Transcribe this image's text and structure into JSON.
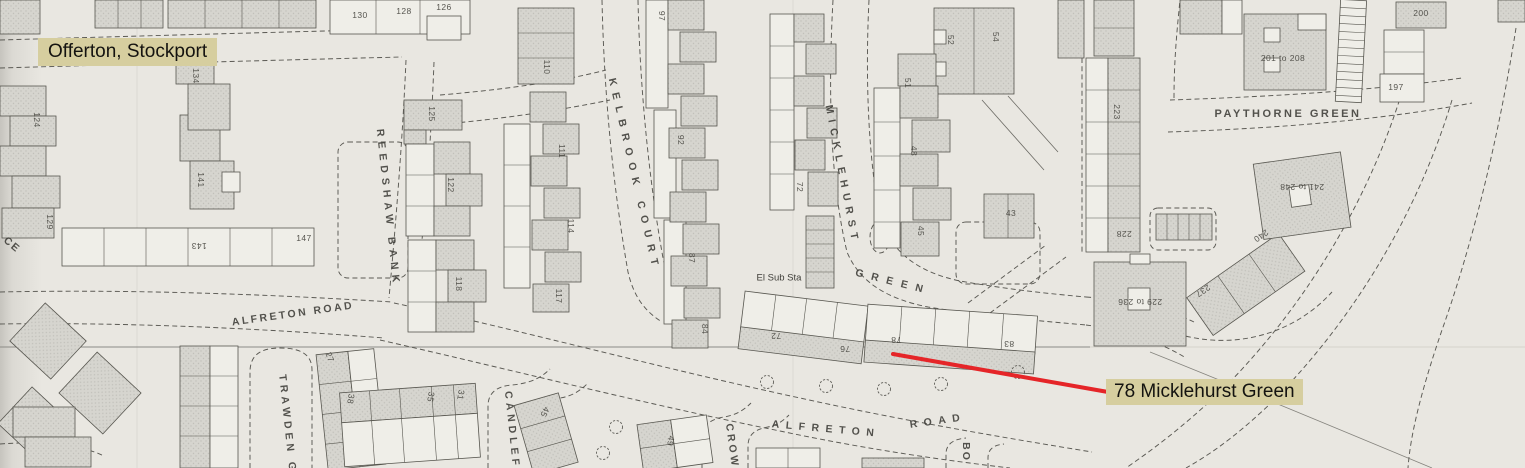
{
  "map": {
    "colors": {
      "highlight": "#d6ce9f",
      "pointer": "#e52528",
      "paper": "#e9e7e1",
      "building_fill": "#d6d5cf",
      "line_ink": "#57564f"
    },
    "annotation": {
      "region_note": "Offerton, Stockport",
      "target_note": "78 Micklehurst Green",
      "pointer_line": {
        "x1": 893,
        "y1": 354,
        "x2": 1108,
        "y2": 392
      }
    },
    "street_labels": [
      {
        "t": "REEDSHAW  BANK",
        "x": 388,
        "y": 208,
        "r": 84,
        "ls": 5,
        "s": 10.5
      },
      {
        "t": "KELBROOK  COURT",
        "x": 634,
        "y": 175,
        "r": 77,
        "ls": 7,
        "s": 10.5
      },
      {
        "t": "MICKLEHURST",
        "x": 842,
        "y": 175,
        "r": 79,
        "ls": 6,
        "s": 10.5
      },
      {
        "t": "GREEN",
        "x": 893,
        "y": 282,
        "r": 14,
        "ls": 8,
        "s": 10.5
      },
      {
        "t": "PAYTHORNE  GREEN",
        "x": 1288,
        "y": 114,
        "r": 0,
        "ls": 2.5,
        "s": 11
      },
      {
        "t": "ALFRETON  ROAD",
        "x": 293,
        "y": 314,
        "r": -8,
        "ls": 2.5,
        "s": 10.5
      },
      {
        "t": "ALFRETON",
        "x": 826,
        "y": 429,
        "r": 5,
        "ls": 6.5,
        "s": 10.5
      },
      {
        "t": "ROAD",
        "x": 938,
        "y": 421,
        "r": -8,
        "ls": 6.5,
        "s": 10.5
      },
      {
        "t": "TRAWDEN  GR",
        "x": 288,
        "y": 430,
        "r": 84,
        "ls": 4,
        "s": 10.5
      },
      {
        "t": "CANDLEF",
        "x": 512,
        "y": 430,
        "r": 84,
        "ls": 4,
        "s": 10.5
      },
      {
        "t": "CROW",
        "x": 732,
        "y": 446,
        "r": 82,
        "ls": 3,
        "s": 10.5
      },
      {
        "t": "BO",
        "x": 966,
        "y": 452,
        "r": 90,
        "ls": 2,
        "s": 10.5
      },
      {
        "t": "CE",
        "x": 12,
        "y": 245,
        "r": 40,
        "ls": 2,
        "s": 10.5
      }
    ],
    "feature_labels": [
      {
        "t": "El Sub Sta",
        "x": 779,
        "y": 278,
        "r": 0,
        "ls": 0,
        "s": 9.5
      }
    ],
    "house_numbers": [
      {
        "t": "124",
        "x": 37,
        "y": 120,
        "r": 90
      },
      {
        "t": "129",
        "x": 50,
        "y": 222,
        "r": 90
      },
      {
        "t": "134",
        "x": 196,
        "y": 76,
        "r": 90
      },
      {
        "t": "141",
        "x": 201,
        "y": 180,
        "r": 90
      },
      {
        "t": "143",
        "x": 199,
        "y": 246,
        "r": 180
      },
      {
        "t": "147",
        "x": 304,
        "y": 238,
        "r": 0
      },
      {
        "t": "130",
        "x": 360,
        "y": 15,
        "r": 0
      },
      {
        "t": "128",
        "x": 404,
        "y": 11,
        "r": 0
      },
      {
        "t": "126",
        "x": 444,
        "y": 7,
        "r": 0
      },
      {
        "t": "125",
        "x": 432,
        "y": 114,
        "r": 90
      },
      {
        "t": "122",
        "x": 451,
        "y": 185,
        "r": 90
      },
      {
        "t": "118",
        "x": 459,
        "y": 284,
        "r": 90
      },
      {
        "t": "110",
        "x": 547,
        "y": 67,
        "r": 90
      },
      {
        "t": "111",
        "x": 562,
        "y": 151,
        "r": 90
      },
      {
        "t": "114",
        "x": 571,
        "y": 226,
        "r": 90
      },
      {
        "t": "117",
        "x": 559,
        "y": 296,
        "r": 90
      },
      {
        "t": "97",
        "x": 662,
        "y": 16,
        "r": 90
      },
      {
        "t": "92",
        "x": 681,
        "y": 140,
        "r": 90
      },
      {
        "t": "87",
        "x": 692,
        "y": 258,
        "r": 90
      },
      {
        "t": "84",
        "x": 705,
        "y": 329,
        "r": 90
      },
      {
        "t": "72",
        "x": 800,
        "y": 187,
        "r": 90
      },
      {
        "t": "52",
        "x": 951,
        "y": 40,
        "r": 90
      },
      {
        "t": "54",
        "x": 996,
        "y": 37,
        "r": 90
      },
      {
        "t": "51",
        "x": 908,
        "y": 83,
        "r": 90
      },
      {
        "t": "48",
        "x": 914,
        "y": 151,
        "r": 90
      },
      {
        "t": "45",
        "x": 921,
        "y": 231,
        "r": 90
      },
      {
        "t": "43",
        "x": 1011,
        "y": 213,
        "r": 0
      },
      {
        "t": "27",
        "x": 330,
        "y": 357,
        "r": 70
      },
      {
        "t": "38",
        "x": 351,
        "y": 399,
        "r": 100
      },
      {
        "t": "35",
        "x": 431,
        "y": 397,
        "r": 100
      },
      {
        "t": "31",
        "x": 461,
        "y": 395,
        "r": 100
      },
      {
        "t": "45",
        "x": 545,
        "y": 412,
        "r": 115
      },
      {
        "t": "49",
        "x": 671,
        "y": 441,
        "r": 100
      },
      {
        "t": "72",
        "x": 776,
        "y": 336,
        "r": 180
      },
      {
        "t": "76",
        "x": 845,
        "y": 349,
        "r": 180
      },
      {
        "t": "78",
        "x": 896,
        "y": 340,
        "r": 180
      },
      {
        "t": "83",
        "x": 1009,
        "y": 344,
        "r": 180
      },
      {
        "t": "223",
        "x": 1117,
        "y": 112,
        "r": 90
      },
      {
        "t": "228",
        "x": 1124,
        "y": 234,
        "r": 180
      },
      {
        "t": "237",
        "x": 1203,
        "y": 291,
        "r": 145
      },
      {
        "t": "240",
        "x": 1261,
        "y": 236,
        "r": 145
      },
      {
        "t": "197",
        "x": 1396,
        "y": 87,
        "r": 0
      },
      {
        "t": "200",
        "x": 1421,
        "y": 13,
        "r": 0
      },
      {
        "t": "201 to 208",
        "x": 1283,
        "y": 58,
        "r": 0
      },
      {
        "t": "229 to 236",
        "x": 1140,
        "y": 302,
        "r": 180
      },
      {
        "t": "241 to 248",
        "x": 1302,
        "y": 187,
        "r": 180
      }
    ]
  }
}
